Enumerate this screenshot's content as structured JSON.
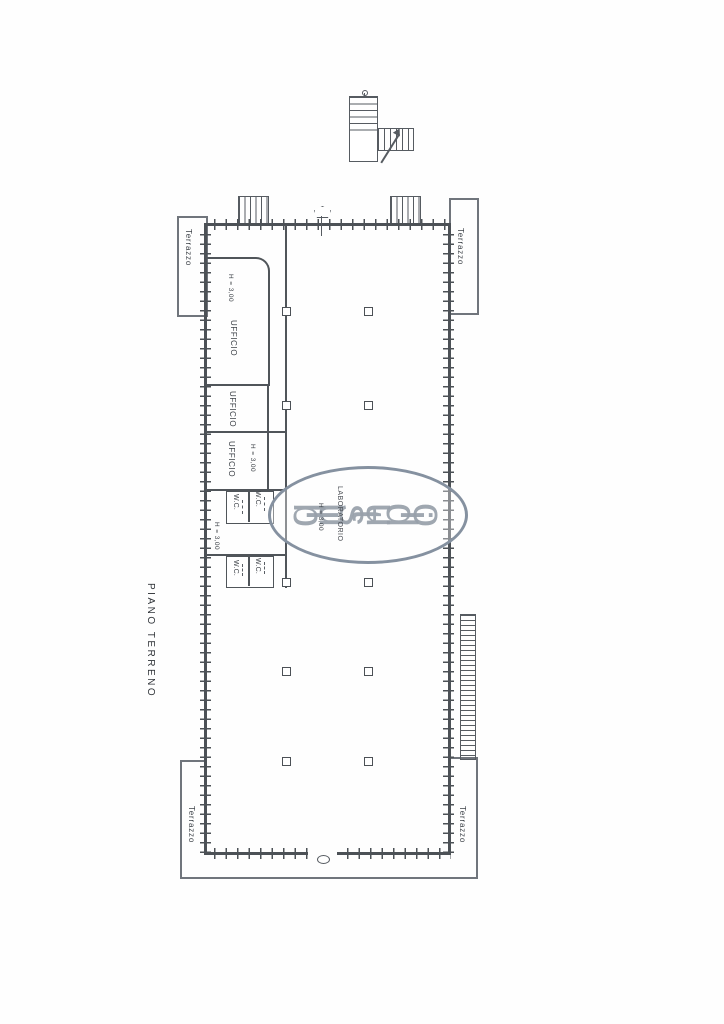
{
  "floor_plan": {
    "title": "PIANO TERRENO",
    "watermark": "blustudio",
    "rooms": {
      "ufficio_top": {
        "label": "UFFICIO",
        "height": "H = 3,00"
      },
      "ufficio_mid": {
        "label": "UFFICIO"
      },
      "ufficio_low": {
        "label": "UFFICIO",
        "height": "H = 3,00"
      },
      "wc_hall": {
        "height": "H = 3,00"
      },
      "wc_a": "W.C.",
      "wc_b": "W.C.",
      "wc_c": "W.C.",
      "wc_d": "W.C.",
      "laboratorio": {
        "label": "LABORATORIO",
        "height": "H = 3,00"
      }
    },
    "terraces": {
      "top_left": "Terrazzo",
      "top_right": "Terrazzo",
      "bottom_left": "Terrazzo",
      "bottom_right": "Terrazzo"
    },
    "colors": {
      "wall_line": "#4c5156",
      "terrace_line": "#70757c",
      "watermark_text": "#98a0aa",
      "watermark_ellipse": "#8591a0"
    }
  }
}
